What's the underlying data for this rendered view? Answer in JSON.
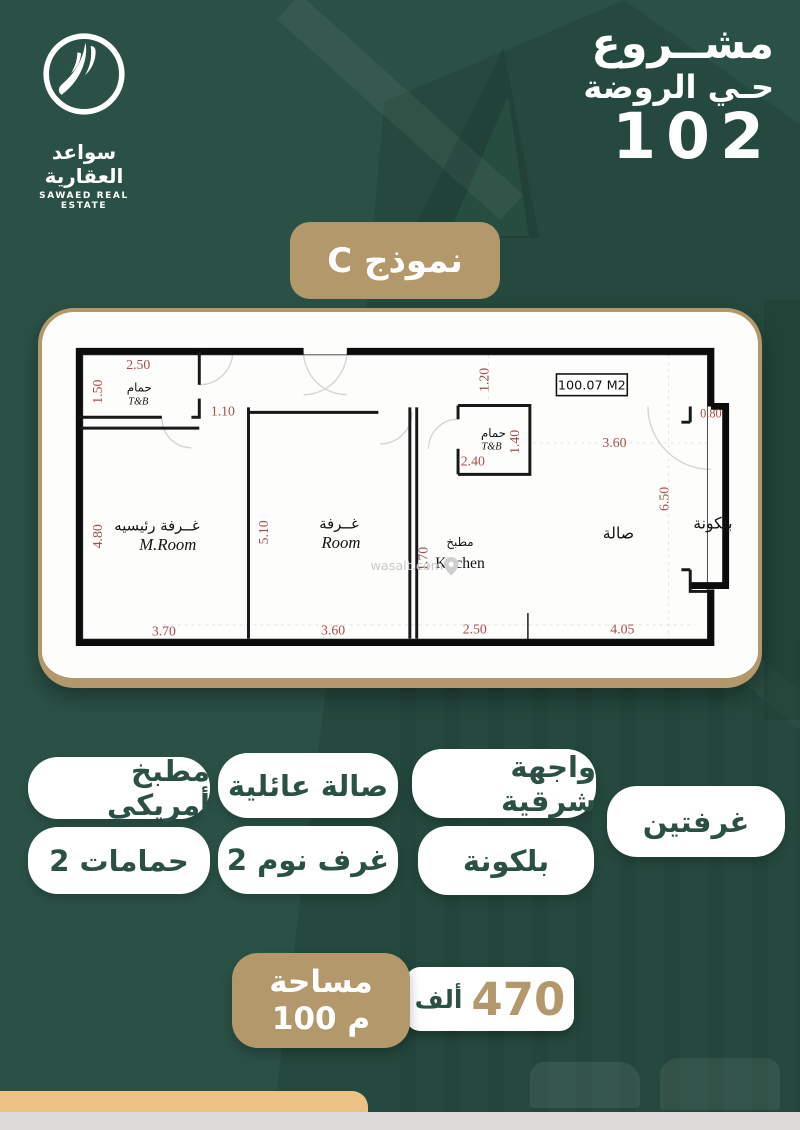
{
  "brand": {
    "logo_icon": "feather-icon",
    "name_ar": "سواعد العقارية",
    "name_en": "SAWAED REAL ESTATE"
  },
  "project": {
    "title": "مشــروع",
    "district": "حـي الروضة",
    "number": "102"
  },
  "model_badge": {
    "label": "نموذج C"
  },
  "plan": {
    "area_box": "100.07 M2",
    "watermark": "wasalt.com",
    "labels": {
      "bath1_ar": "حمام",
      "bath1_en": "T&B",
      "master_ar": "غــرفة رئيسيه",
      "master_en": "M.Room",
      "room_ar": "غــرفة",
      "room_en": "Room",
      "kitchen_ar": "مطبخ",
      "kitchen_en": "Kitchen",
      "bath2_ar": "حمام",
      "bath2_en": "T&B",
      "hall_ar": "صالة",
      "balcony_ar": "بلكونة"
    },
    "dims": {
      "bath1_w": "2.50",
      "bath1_h": "1.50",
      "passage": "1.10",
      "master_h": "4.80",
      "master_w": "3.70",
      "room_h": "5.10",
      "room_w": "3.60",
      "kitchen_h": "1.70",
      "kitchen_w": "2.50",
      "bath2_w": "2.40",
      "bath2_h": "1.40",
      "vestibule": "1.20",
      "hall_top": "3.60",
      "hall_w": "4.05",
      "hall_h": "6.50",
      "balcony_w": "0.80"
    }
  },
  "features": [
    "مطبخ أمريكي",
    "صالة عائلية",
    "واجهة شرقية",
    "2 حمامات",
    "2 غرف نوم",
    "بلكونة",
    "غرفتين"
  ],
  "area_badge": {
    "line1": "مساحة",
    "line2": "100 م"
  },
  "price_badge": {
    "value": "470",
    "unit": "ألف"
  },
  "colors": {
    "background_green": "#2b5146",
    "accent_tan": "#b3986c",
    "gold_bar": "#ebc284",
    "pill_text_green": "#2b5045",
    "dimension_red": "#a34f4b"
  }
}
